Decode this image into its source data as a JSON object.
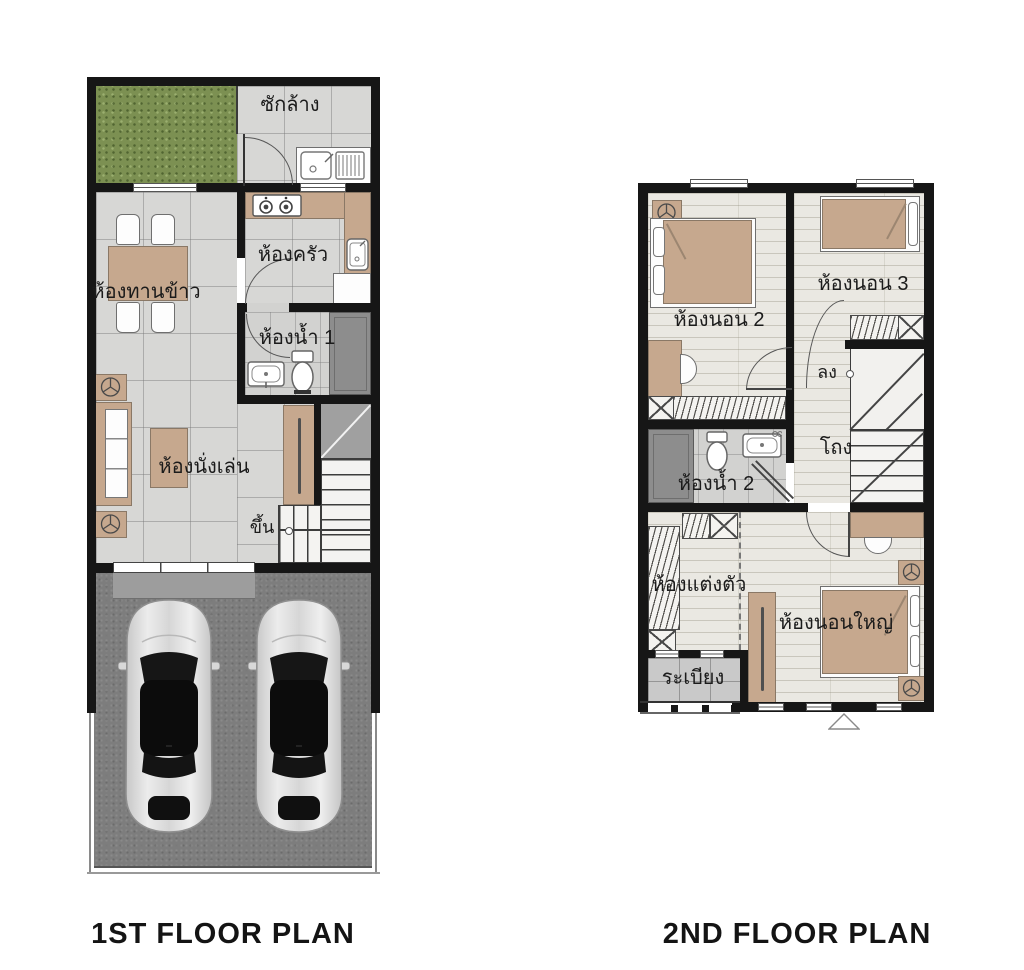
{
  "page": {
    "background": "#ffffff"
  },
  "palette": {
    "wall": "#161616",
    "tile_floor": "#d7d7d5",
    "wood_floor": "#eae8e2",
    "grass_green": "#7c9052",
    "concrete_gray": "#7d7d7d",
    "furniture_brown": "#c6a88e",
    "shower_gray": "#8d8d8d",
    "balcony_tile": "#c9c9c9"
  },
  "floor1": {
    "title": "1ST FLOOR PLAN",
    "labels": {
      "laundry": "ซักล้าง",
      "kitchen": "ห้องครัว",
      "dining": "ห้องทานข้าว",
      "bath1": "ห้องน้ำ 1",
      "living": "ห้องนั่งเล่น",
      "up": "ขึ้น"
    }
  },
  "floor2": {
    "title": "2ND FLOOR PLAN",
    "labels": {
      "bedroom2": "ห้องนอน 2",
      "bedroom3": "ห้องนอน 3",
      "down": "ลง",
      "hall": "โถง",
      "bath2": "ห้องน้ำ 2",
      "dressing": "ห้องแต่งตัว",
      "master": "ห้องนอนใหญ่",
      "balcony": "ระเบียง"
    }
  }
}
